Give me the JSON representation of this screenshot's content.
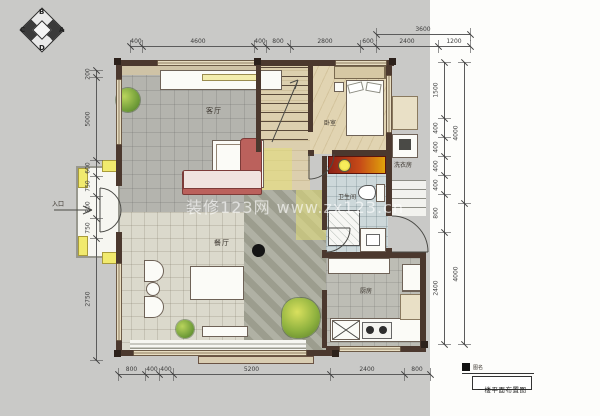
{
  "meta": {
    "watermark": "装修123网 www.zx123.cn"
  },
  "compass": {
    "letters": [
      "B",
      "C",
      "A",
      "D"
    ]
  },
  "rooms": {
    "living": "客厅",
    "dining": "餐厅",
    "kitchen": "厨房",
    "bedroom": "卧室",
    "bathroom": "卫生间",
    "laundry": "洗衣房"
  },
  "entry": {
    "label": "入口"
  },
  "title_block": {
    "name_label": "图名",
    "title": "一楼平面布置图"
  },
  "dimensions": {
    "top": [
      "400",
      "4600",
      "400",
      "800",
      "2800",
      "600",
      "2400",
      "1200"
    ],
    "top_overall": "3600",
    "bottom": [
      "800",
      "400",
      "400",
      "5200",
      "2400",
      "800"
    ],
    "left": [
      "200",
      "5000",
      "600",
      "750",
      "800",
      "750",
      "2750"
    ],
    "right": [
      "1500",
      "400",
      "400",
      "400",
      "400",
      "800",
      "2400"
    ],
    "right_outer": [
      "4000",
      "4000"
    ]
  }
}
